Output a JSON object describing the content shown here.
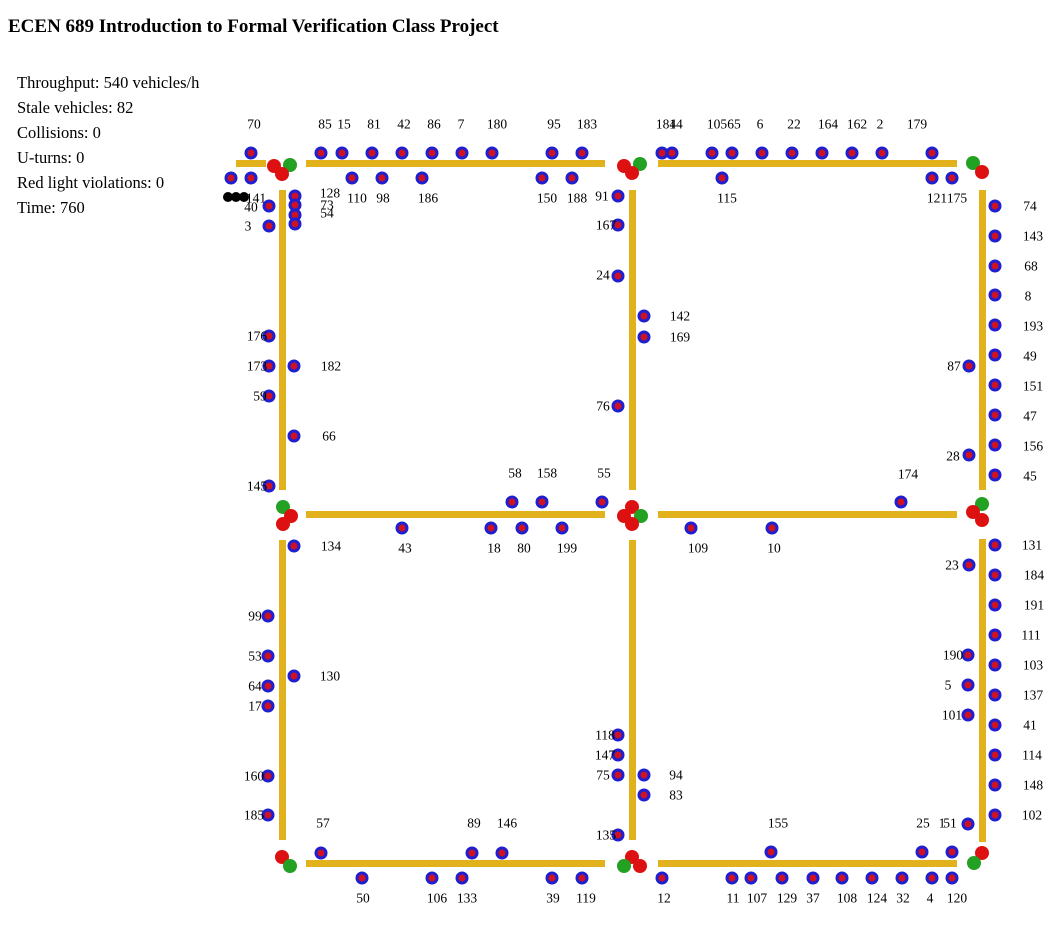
{
  "title": "ECEN 689 Introduction to Formal Verification Class Project",
  "stats": [
    "Throughput: 540 vehicles/h",
    "Stale vehicles: 82",
    "Collisions: 0",
    "U-turns: 0",
    "Red light violations: 0",
    "Time: 760"
  ],
  "colors": {
    "road": "#e2b21c",
    "vehicle_body": "#1f1fd0",
    "vehicle_core": "#cf1222",
    "light_red": "#dd1111",
    "light_green": "#22a122",
    "stale_blob": "#000000",
    "text": "#000000"
  },
  "scene": {
    "roads": [
      {
        "x": 236,
        "y": 160,
        "w": 30,
        "h": 7
      },
      {
        "x": 306,
        "y": 160,
        "w": 299,
        "h": 7
      },
      {
        "x": 658,
        "y": 160,
        "w": 299,
        "h": 7
      },
      {
        "x": 306,
        "y": 511,
        "w": 299,
        "h": 7
      },
      {
        "x": 658,
        "y": 511,
        "w": 299,
        "h": 7
      },
      {
        "x": 306,
        "y": 860,
        "w": 299,
        "h": 7
      },
      {
        "x": 658,
        "y": 860,
        "w": 299,
        "h": 7
      },
      {
        "x": 279,
        "y": 190,
        "w": 7,
        "h": 300
      },
      {
        "x": 279,
        "y": 540,
        "w": 7,
        "h": 300
      },
      {
        "x": 629,
        "y": 190,
        "w": 7,
        "h": 300
      },
      {
        "x": 629,
        "y": 540,
        "w": 7,
        "h": 300
      },
      {
        "x": 979,
        "y": 190,
        "w": 7,
        "h": 300
      },
      {
        "x": 979,
        "y": 539,
        "w": 7,
        "h": 303
      }
    ],
    "lights": [
      {
        "x": 274,
        "y": 166,
        "c": "red"
      },
      {
        "x": 290,
        "y": 165,
        "c": "green"
      },
      {
        "x": 282,
        "y": 174,
        "c": "red"
      },
      {
        "x": 624,
        "y": 166,
        "c": "red"
      },
      {
        "x": 640,
        "y": 164,
        "c": "green"
      },
      {
        "x": 632,
        "y": 173,
        "c": "red"
      },
      {
        "x": 973,
        "y": 163,
        "c": "green"
      },
      {
        "x": 982,
        "y": 172,
        "c": "red"
      },
      {
        "x": 283,
        "y": 507,
        "c": "green"
      },
      {
        "x": 291,
        "y": 516,
        "c": "red"
      },
      {
        "x": 283,
        "y": 524,
        "c": "red"
      },
      {
        "x": 632,
        "y": 507,
        "c": "red"
      },
      {
        "x": 624,
        "y": 516,
        "c": "red"
      },
      {
        "x": 641,
        "y": 516,
        "c": "green"
      },
      {
        "x": 632,
        "y": 524,
        "c": "red"
      },
      {
        "x": 982,
        "y": 504,
        "c": "green"
      },
      {
        "x": 973,
        "y": 512,
        "c": "red"
      },
      {
        "x": 982,
        "y": 520,
        "c": "red"
      },
      {
        "x": 282,
        "y": 857,
        "c": "red"
      },
      {
        "x": 290,
        "y": 866,
        "c": "green"
      },
      {
        "x": 632,
        "y": 857,
        "c": "red"
      },
      {
        "x": 624,
        "y": 866,
        "c": "green"
      },
      {
        "x": 640,
        "y": 866,
        "c": "red"
      },
      {
        "x": 982,
        "y": 853,
        "c": "red"
      },
      {
        "x": 974,
        "y": 863,
        "c": "green"
      }
    ],
    "vehicles": [
      {
        "x": 251,
        "y": 153,
        "label": "70",
        "lx": 254,
        "ly": 124
      },
      {
        "x": 321,
        "y": 153,
        "label": "85",
        "lx": 325,
        "ly": 124
      },
      {
        "x": 342,
        "y": 153,
        "label": "15",
        "lx": 344,
        "ly": 124
      },
      {
        "x": 372,
        "y": 153,
        "label": "81",
        "lx": 374,
        "ly": 124
      },
      {
        "x": 402,
        "y": 153,
        "label": "42",
        "lx": 404,
        "ly": 124
      },
      {
        "x": 432,
        "y": 153,
        "label": "86",
        "lx": 434,
        "ly": 124
      },
      {
        "x": 462,
        "y": 153,
        "label": "7",
        "lx": 461,
        "ly": 124
      },
      {
        "x": 492,
        "y": 153,
        "label": "180",
        "lx": 497,
        "ly": 124
      },
      {
        "x": 552,
        "y": 153,
        "label": "95",
        "lx": 554,
        "ly": 124
      },
      {
        "x": 582,
        "y": 153,
        "label": "183",
        "lx": 587,
        "ly": 124
      },
      {
        "x": 662,
        "y": 153,
        "label": "184",
        "lx": 666,
        "ly": 124
      },
      {
        "x": 672,
        "y": 153,
        "label": "14",
        "lx": 676,
        "ly": 124
      },
      {
        "x": 712,
        "y": 153,
        "label": "105",
        "lx": 717,
        "ly": 124
      },
      {
        "x": 732,
        "y": 153,
        "label": "65",
        "lx": 734,
        "ly": 124
      },
      {
        "x": 762,
        "y": 153,
        "label": "6",
        "lx": 760,
        "ly": 124
      },
      {
        "x": 792,
        "y": 153,
        "label": "22",
        "lx": 794,
        "ly": 124
      },
      {
        "x": 822,
        "y": 153,
        "label": "164",
        "lx": 828,
        "ly": 124
      },
      {
        "x": 852,
        "y": 153,
        "label": "162",
        "lx": 857,
        "ly": 124
      },
      {
        "x": 882,
        "y": 153,
        "label": "2",
        "lx": 880,
        "ly": 124
      },
      {
        "x": 932,
        "y": 153,
        "label": "179",
        "lx": 917,
        "ly": 124
      },
      {
        "x": 231,
        "y": 178,
        "label": "",
        "lx": 0,
        "ly": 0
      },
      {
        "x": 251,
        "y": 178,
        "label": "141",
        "lx": 256,
        "ly": 198
      },
      {
        "x": 352,
        "y": 178,
        "label": "110",
        "lx": 357,
        "ly": 198
      },
      {
        "x": 382,
        "y": 178,
        "label": "98",
        "lx": 383,
        "ly": 198
      },
      {
        "x": 422,
        "y": 178,
        "label": "186",
        "lx": 428,
        "ly": 198
      },
      {
        "x": 542,
        "y": 178,
        "label": "150",
        "lx": 547,
        "ly": 198
      },
      {
        "x": 572,
        "y": 178,
        "label": "188",
        "lx": 577,
        "ly": 198
      },
      {
        "x": 722,
        "y": 178,
        "label": "115",
        "lx": 727,
        "ly": 198
      },
      {
        "x": 932,
        "y": 178,
        "label": "121",
        "lx": 937,
        "ly": 198
      },
      {
        "x": 952,
        "y": 178,
        "label": "175",
        "lx": 957,
        "ly": 198
      },
      {
        "x": 269,
        "y": 206,
        "label": "40",
        "lx": 251,
        "ly": 207
      },
      {
        "x": 269,
        "y": 226,
        "label": "3",
        "lx": 248,
        "ly": 226
      },
      {
        "x": 269,
        "y": 336,
        "label": "176",
        "lx": 257,
        "ly": 336
      },
      {
        "x": 269,
        "y": 366,
        "label": "173",
        "lx": 257,
        "ly": 366
      },
      {
        "x": 269,
        "y": 396,
        "label": "59",
        "lx": 260,
        "ly": 396
      },
      {
        "x": 269,
        "y": 486,
        "label": "145",
        "lx": 257,
        "ly": 486
      },
      {
        "x": 268,
        "y": 616,
        "label": "99",
        "lx": 255,
        "ly": 616
      },
      {
        "x": 268,
        "y": 656,
        "label": "53",
        "lx": 255,
        "ly": 656
      },
      {
        "x": 268,
        "y": 686,
        "label": "64",
        "lx": 255,
        "ly": 686
      },
      {
        "x": 268,
        "y": 706,
        "label": "17",
        "lx": 255,
        "ly": 706
      },
      {
        "x": 268,
        "y": 776,
        "label": "160",
        "lx": 254,
        "ly": 776
      },
      {
        "x": 268,
        "y": 815,
        "label": "185",
        "lx": 254,
        "ly": 815
      },
      {
        "x": 295,
        "y": 196,
        "label": "128",
        "lx": 330,
        "ly": 193
      },
      {
        "x": 295,
        "y": 205,
        "label": "73",
        "lx": 327,
        "ly": 205
      },
      {
        "x": 295,
        "y": 215,
        "label": "54",
        "lx": 327,
        "ly": 213
      },
      {
        "x": 295,
        "y": 224,
        "label": "",
        "lx": 0,
        "ly": 0
      },
      {
        "x": 294,
        "y": 366,
        "label": "182",
        "lx": 331,
        "ly": 366
      },
      {
        "x": 294,
        "y": 436,
        "label": "66",
        "lx": 329,
        "ly": 436
      },
      {
        "x": 294,
        "y": 546,
        "label": "134",
        "lx": 331,
        "ly": 546
      },
      {
        "x": 294,
        "y": 676,
        "label": "130",
        "lx": 330,
        "ly": 676
      },
      {
        "x": 512,
        "y": 502,
        "label": "58",
        "lx": 515,
        "ly": 473
      },
      {
        "x": 542,
        "y": 502,
        "label": "158",
        "lx": 547,
        "ly": 473
      },
      {
        "x": 602,
        "y": 502,
        "label": "55",
        "lx": 604,
        "ly": 473
      },
      {
        "x": 901,
        "y": 502,
        "label": "174",
        "lx": 908,
        "ly": 474
      },
      {
        "x": 402,
        "y": 528,
        "label": "43",
        "lx": 405,
        "ly": 548
      },
      {
        "x": 491,
        "y": 528,
        "label": "18",
        "lx": 494,
        "ly": 548
      },
      {
        "x": 522,
        "y": 528,
        "label": "80",
        "lx": 524,
        "ly": 548
      },
      {
        "x": 562,
        "y": 528,
        "label": "199",
        "lx": 567,
        "ly": 548
      },
      {
        "x": 691,
        "y": 528,
        "label": "109",
        "lx": 698,
        "ly": 548
      },
      {
        "x": 772,
        "y": 528,
        "label": "10",
        "lx": 774,
        "ly": 548
      },
      {
        "x": 618,
        "y": 196,
        "label": "91",
        "lx": 602,
        "ly": 196
      },
      {
        "x": 618,
        "y": 225,
        "label": "167",
        "lx": 606,
        "ly": 225
      },
      {
        "x": 618,
        "y": 276,
        "label": "24",
        "lx": 603,
        "ly": 275
      },
      {
        "x": 618,
        "y": 406,
        "label": "76",
        "lx": 603,
        "ly": 406
      },
      {
        "x": 618,
        "y": 735,
        "label": "118",
        "lx": 605,
        "ly": 735
      },
      {
        "x": 618,
        "y": 755,
        "label": "147",
        "lx": 605,
        "ly": 755
      },
      {
        "x": 618,
        "y": 775,
        "label": "75",
        "lx": 603,
        "ly": 775
      },
      {
        "x": 618,
        "y": 835,
        "label": "135",
        "lx": 606,
        "ly": 835
      },
      {
        "x": 644,
        "y": 316,
        "label": "142",
        "lx": 680,
        "ly": 316
      },
      {
        "x": 644,
        "y": 337,
        "label": "169",
        "lx": 680,
        "ly": 337
      },
      {
        "x": 644,
        "y": 775,
        "label": "94",
        "lx": 676,
        "ly": 775
      },
      {
        "x": 644,
        "y": 795,
        "label": "83",
        "lx": 676,
        "ly": 795
      },
      {
        "x": 969,
        "y": 366,
        "label": "87",
        "lx": 954,
        "ly": 366
      },
      {
        "x": 969,
        "y": 455,
        "label": "28",
        "lx": 953,
        "ly": 456
      },
      {
        "x": 969,
        "y": 565,
        "label": "23",
        "lx": 952,
        "ly": 565
      },
      {
        "x": 968,
        "y": 655,
        "label": "190",
        "lx": 953,
        "ly": 655
      },
      {
        "x": 968,
        "y": 685,
        "label": "5",
        "lx": 948,
        "ly": 685
      },
      {
        "x": 968,
        "y": 715,
        "label": "101",
        "lx": 952,
        "ly": 715
      },
      {
        "x": 968,
        "y": 824,
        "label": "51",
        "lx": 950,
        "ly": 823
      },
      {
        "x": 995,
        "y": 206,
        "label": "74",
        "lx": 1030,
        "ly": 206
      },
      {
        "x": 995,
        "y": 236,
        "label": "143",
        "lx": 1033,
        "ly": 236
      },
      {
        "x": 995,
        "y": 266,
        "label": "68",
        "lx": 1031,
        "ly": 266
      },
      {
        "x": 995,
        "y": 295,
        "label": "8",
        "lx": 1028,
        "ly": 296
      },
      {
        "x": 995,
        "y": 325,
        "label": "193",
        "lx": 1033,
        "ly": 326
      },
      {
        "x": 995,
        "y": 355,
        "label": "49",
        "lx": 1030,
        "ly": 356
      },
      {
        "x": 995,
        "y": 385,
        "label": "151",
        "lx": 1033,
        "ly": 386
      },
      {
        "x": 995,
        "y": 415,
        "label": "47",
        "lx": 1030,
        "ly": 416
      },
      {
        "x": 995,
        "y": 445,
        "label": "156",
        "lx": 1033,
        "ly": 446
      },
      {
        "x": 995,
        "y": 475,
        "label": "45",
        "lx": 1030,
        "ly": 476
      },
      {
        "x": 995,
        "y": 545,
        "label": "131",
        "lx": 1032,
        "ly": 545
      },
      {
        "x": 995,
        "y": 575,
        "label": "184",
        "lx": 1034,
        "ly": 575
      },
      {
        "x": 995,
        "y": 605,
        "label": "191",
        "lx": 1034,
        "ly": 605
      },
      {
        "x": 995,
        "y": 635,
        "label": "111",
        "lx": 1031,
        "ly": 635
      },
      {
        "x": 995,
        "y": 665,
        "label": "103",
        "lx": 1033,
        "ly": 665
      },
      {
        "x": 995,
        "y": 695,
        "label": "137",
        "lx": 1033,
        "ly": 695
      },
      {
        "x": 995,
        "y": 725,
        "label": "41",
        "lx": 1030,
        "ly": 725
      },
      {
        "x": 995,
        "y": 755,
        "label": "114",
        "lx": 1032,
        "ly": 755
      },
      {
        "x": 995,
        "y": 785,
        "label": "148",
        "lx": 1033,
        "ly": 785
      },
      {
        "x": 995,
        "y": 815,
        "label": "102",
        "lx": 1032,
        "ly": 815
      },
      {
        "x": 321,
        "y": 853,
        "label": "57",
        "lx": 323,
        "ly": 823
      },
      {
        "x": 472,
        "y": 853,
        "label": "89",
        "lx": 474,
        "ly": 823
      },
      {
        "x": 502,
        "y": 853,
        "label": "146",
        "lx": 507,
        "ly": 823
      },
      {
        "x": 771,
        "y": 852,
        "label": "155",
        "lx": 778,
        "ly": 823
      },
      {
        "x": 922,
        "y": 852,
        "label": "25",
        "lx": 923,
        "ly": 823
      },
      {
        "x": 952,
        "y": 852,
        "label": "1",
        "lx": 942,
        "ly": 823
      },
      {
        "x": 362,
        "y": 878,
        "label": "50",
        "lx": 363,
        "ly": 898
      },
      {
        "x": 432,
        "y": 878,
        "label": "106",
        "lx": 437,
        "ly": 898
      },
      {
        "x": 462,
        "y": 878,
        "label": "133",
        "lx": 467,
        "ly": 898
      },
      {
        "x": 552,
        "y": 878,
        "label": "39",
        "lx": 553,
        "ly": 898
      },
      {
        "x": 582,
        "y": 878,
        "label": "119",
        "lx": 586,
        "ly": 898
      },
      {
        "x": 662,
        "y": 878,
        "label": "12",
        "lx": 664,
        "ly": 898
      },
      {
        "x": 732,
        "y": 878,
        "label": "11",
        "lx": 733,
        "ly": 898
      },
      {
        "x": 751,
        "y": 878,
        "label": "107",
        "lx": 757,
        "ly": 898
      },
      {
        "x": 782,
        "y": 878,
        "label": "129",
        "lx": 787,
        "ly": 898
      },
      {
        "x": 813,
        "y": 878,
        "label": "37",
        "lx": 813,
        "ly": 898
      },
      {
        "x": 842,
        "y": 878,
        "label": "108",
        "lx": 847,
        "ly": 898
      },
      {
        "x": 872,
        "y": 878,
        "label": "124",
        "lx": 877,
        "ly": 898
      },
      {
        "x": 902,
        "y": 878,
        "label": "32",
        "lx": 903,
        "ly": 898
      },
      {
        "x": 932,
        "y": 878,
        "label": "4",
        "lx": 930,
        "ly": 898
      },
      {
        "x": 952,
        "y": 878,
        "label": "120",
        "lx": 957,
        "ly": 898
      }
    ],
    "stale_blob": {
      "dots": [
        [
          228,
          197
        ],
        [
          236,
          197
        ],
        [
          244,
          197
        ]
      ]
    }
  }
}
